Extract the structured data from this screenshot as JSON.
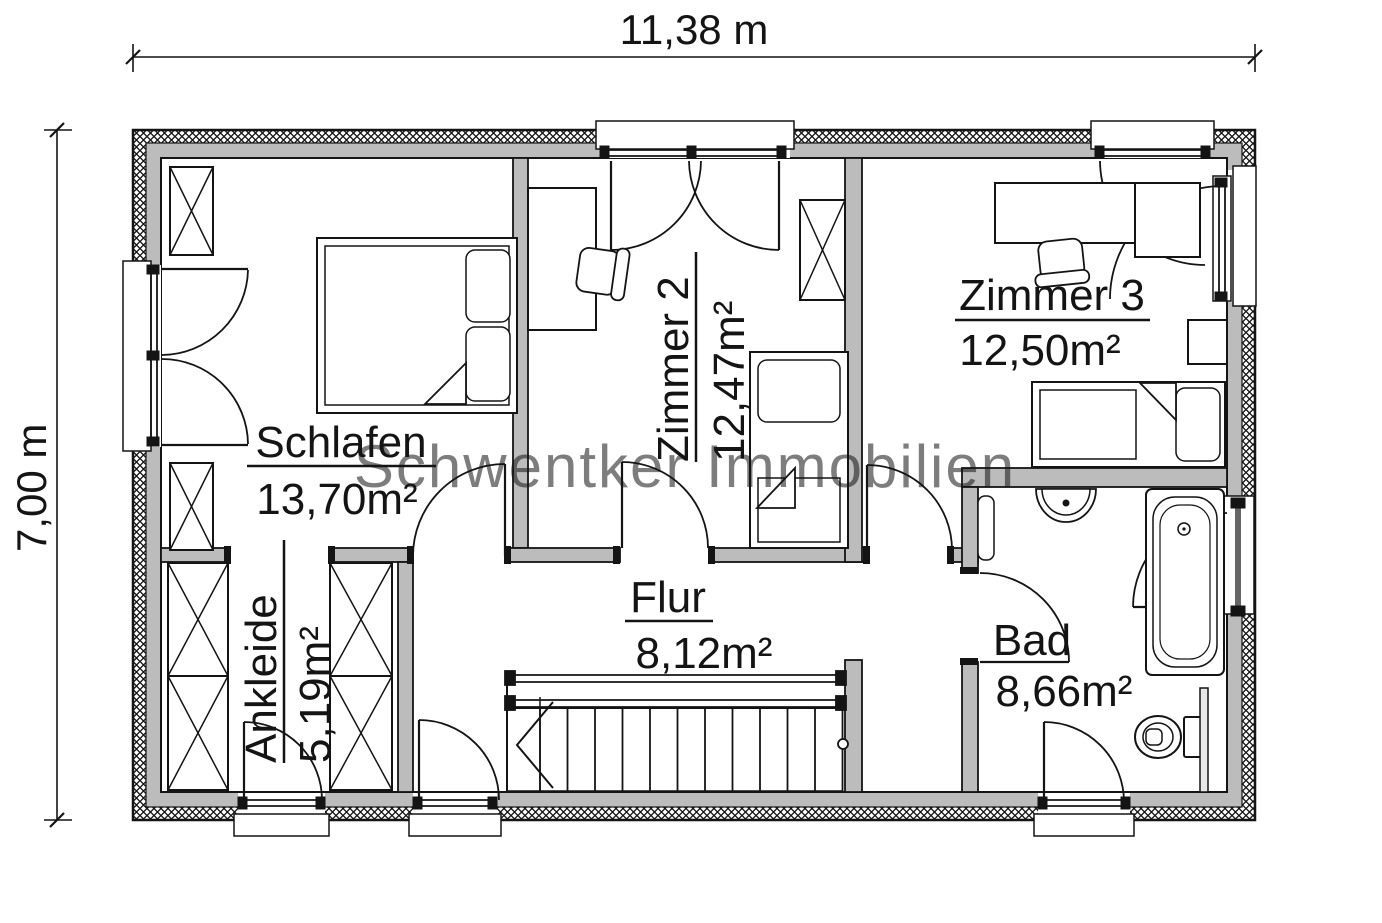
{
  "plan": {
    "watermark": "Schwentker Immobilien",
    "dimension_width": "11,38 m",
    "dimension_height": "7,00 m",
    "rooms": [
      {
        "name": "Schlafen",
        "area": "13,70m²"
      },
      {
        "name": "Zimmer 2",
        "area": "12,47m²"
      },
      {
        "name": "Zimmer 3",
        "area": "12,50m²"
      },
      {
        "name": "Ankleide",
        "area": "5,19m²"
      },
      {
        "name": "Flur",
        "area": "8,12m²"
      },
      {
        "name": "Bad",
        "area": "8,66m²"
      }
    ],
    "colors": {
      "wall": "#bcbcbc",
      "line": "#141414",
      "watermark": "#8a8a8a"
    }
  }
}
